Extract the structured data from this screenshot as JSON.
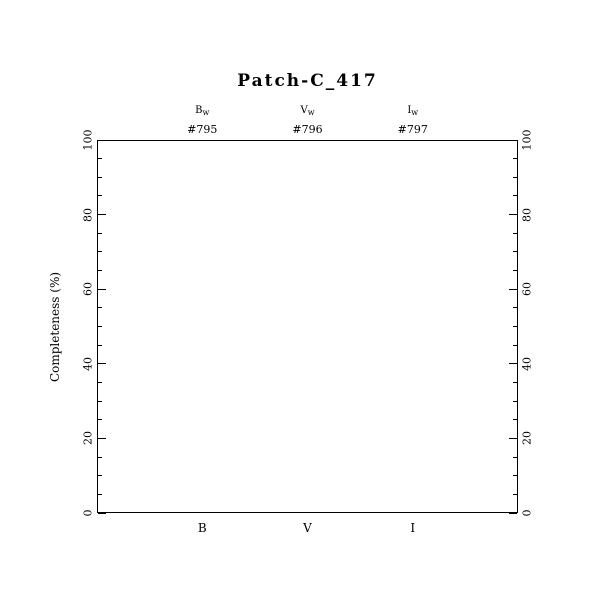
{
  "figure": {
    "background": "#ffffff",
    "foreground": "#000000"
  },
  "chart_data": {
    "type": "scatter",
    "title": "Patch-C_417",
    "xlabel": "",
    "ylabel": "Completeness (%)",
    "ylim": [
      0,
      100
    ],
    "y_major_ticks": [
      0,
      20,
      40,
      60,
      80,
      100
    ],
    "y_minor_tick_step": 5,
    "y_ticks_mirrored_right": true,
    "grid": false,
    "legend": null,
    "x_categories": [
      "B",
      "V",
      "I"
    ],
    "x_positions_frac": [
      0.25,
      0.5,
      0.75
    ],
    "top_headers": [
      {
        "filter": "B",
        "subscript": "w",
        "id": "#795"
      },
      {
        "filter": "V",
        "subscript": "w",
        "id": "#796"
      },
      {
        "filter": "I",
        "subscript": "w",
        "id": "#797"
      }
    ],
    "series": []
  }
}
